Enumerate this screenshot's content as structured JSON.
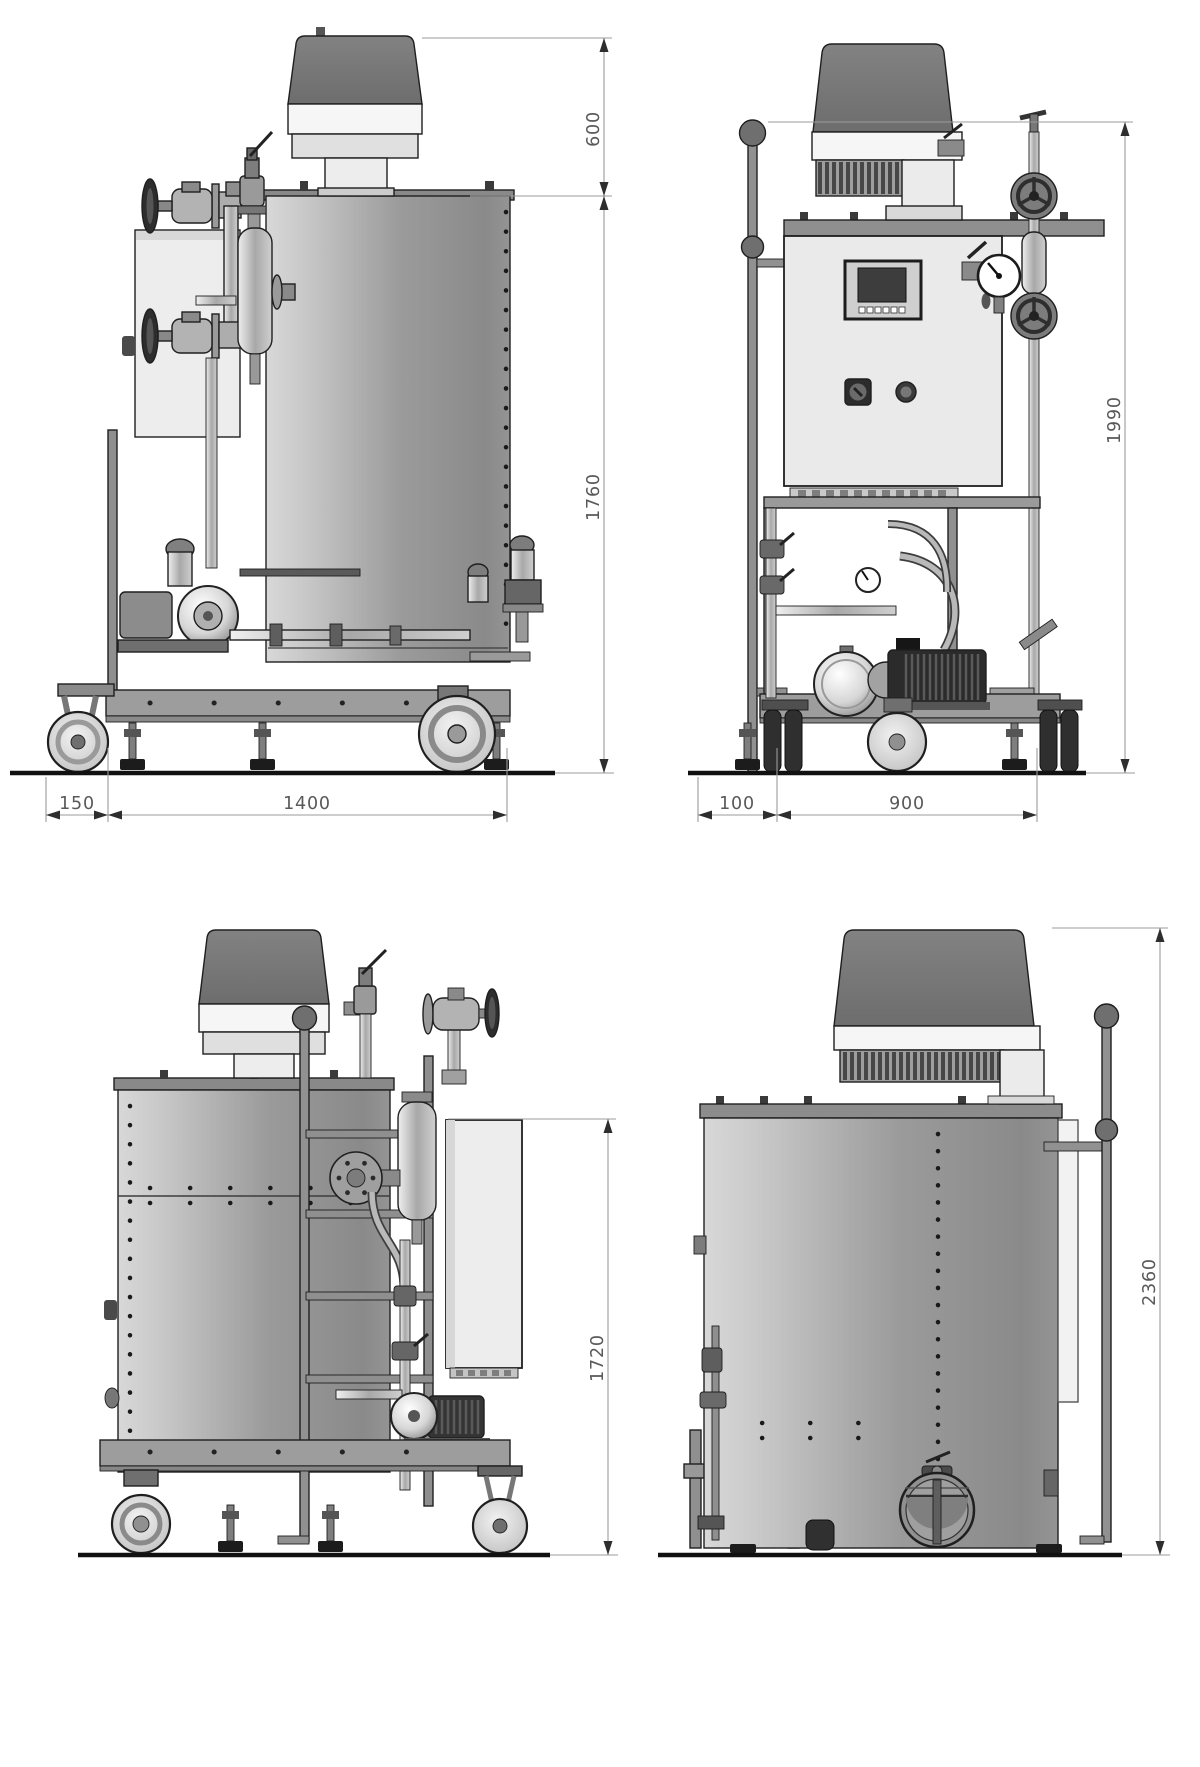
{
  "drawing": {
    "type": "orthographic-engineering-drawing",
    "views": {
      "side_right": {
        "dims": {
          "head_height": "600",
          "body_height": "1760",
          "caster_offset": "150",
          "frame_length": "1400"
        }
      },
      "front": {
        "dims": {
          "overall_height": "1990",
          "handle_offset": "100",
          "frame_width": "900"
        }
      },
      "side_left": {
        "dims": {
          "overall_height": "1720"
        }
      },
      "rear": {
        "dims": {
          "overall_height": "2360"
        }
      }
    },
    "colors": {
      "background": "#ffffff",
      "outline": "#1f1f1f",
      "ground_line": "#111111",
      "dimension_line": "#9b9b9b",
      "dimension_text": "#595959",
      "tank_light": "#d8d8d8",
      "tank_dark": "#8a8a8a",
      "valve_head": "#777777",
      "white_band": "#f6f6f6",
      "cabinet": "#eaeaea",
      "frame": "#9d9d9d"
    }
  }
}
